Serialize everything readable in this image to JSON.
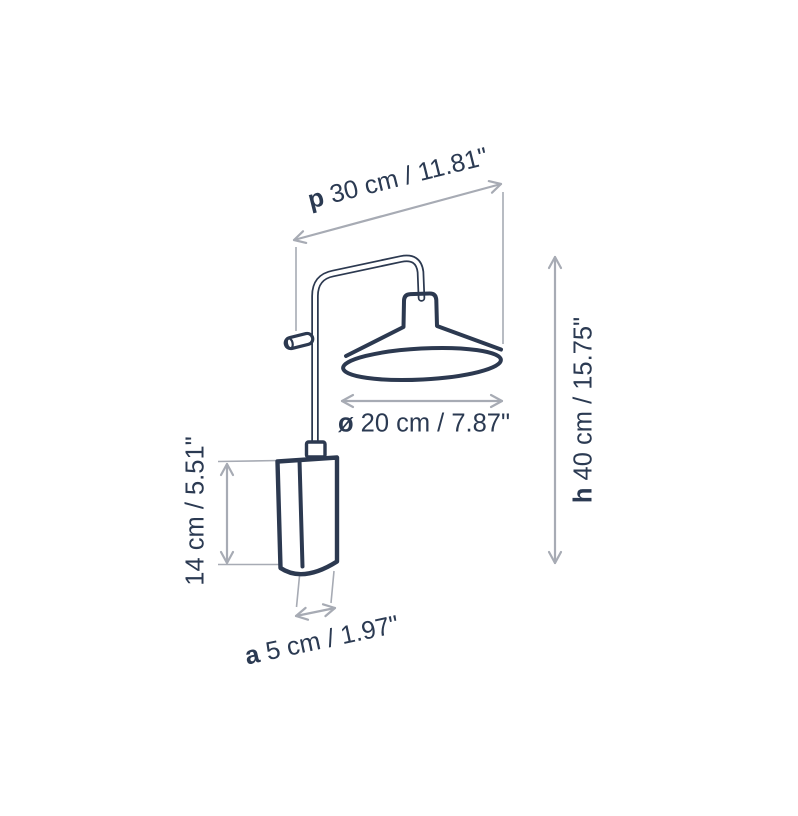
{
  "canvas": {
    "width": 798,
    "height": 816
  },
  "colors": {
    "ink": "#2c3950",
    "dim_line": "#a7abb4",
    "label_text": "#2b3a52",
    "background": "#ffffff"
  },
  "diagram": {
    "name": "Wall lamp dimension drawing",
    "labels": {
      "projection": {
        "prefix": "p",
        "value": "30 cm / 11.81\""
      },
      "height": {
        "prefix": "h",
        "value": "40 cm / 15.75\""
      },
      "shade_diameter": {
        "prefix": "ø",
        "value": "20 cm / 7.87\""
      },
      "mount_height": {
        "prefix": "",
        "value": "14 cm / 5.51\""
      },
      "mount_width": {
        "prefix": "a",
        "value": "5 cm / 1.97\""
      }
    }
  }
}
